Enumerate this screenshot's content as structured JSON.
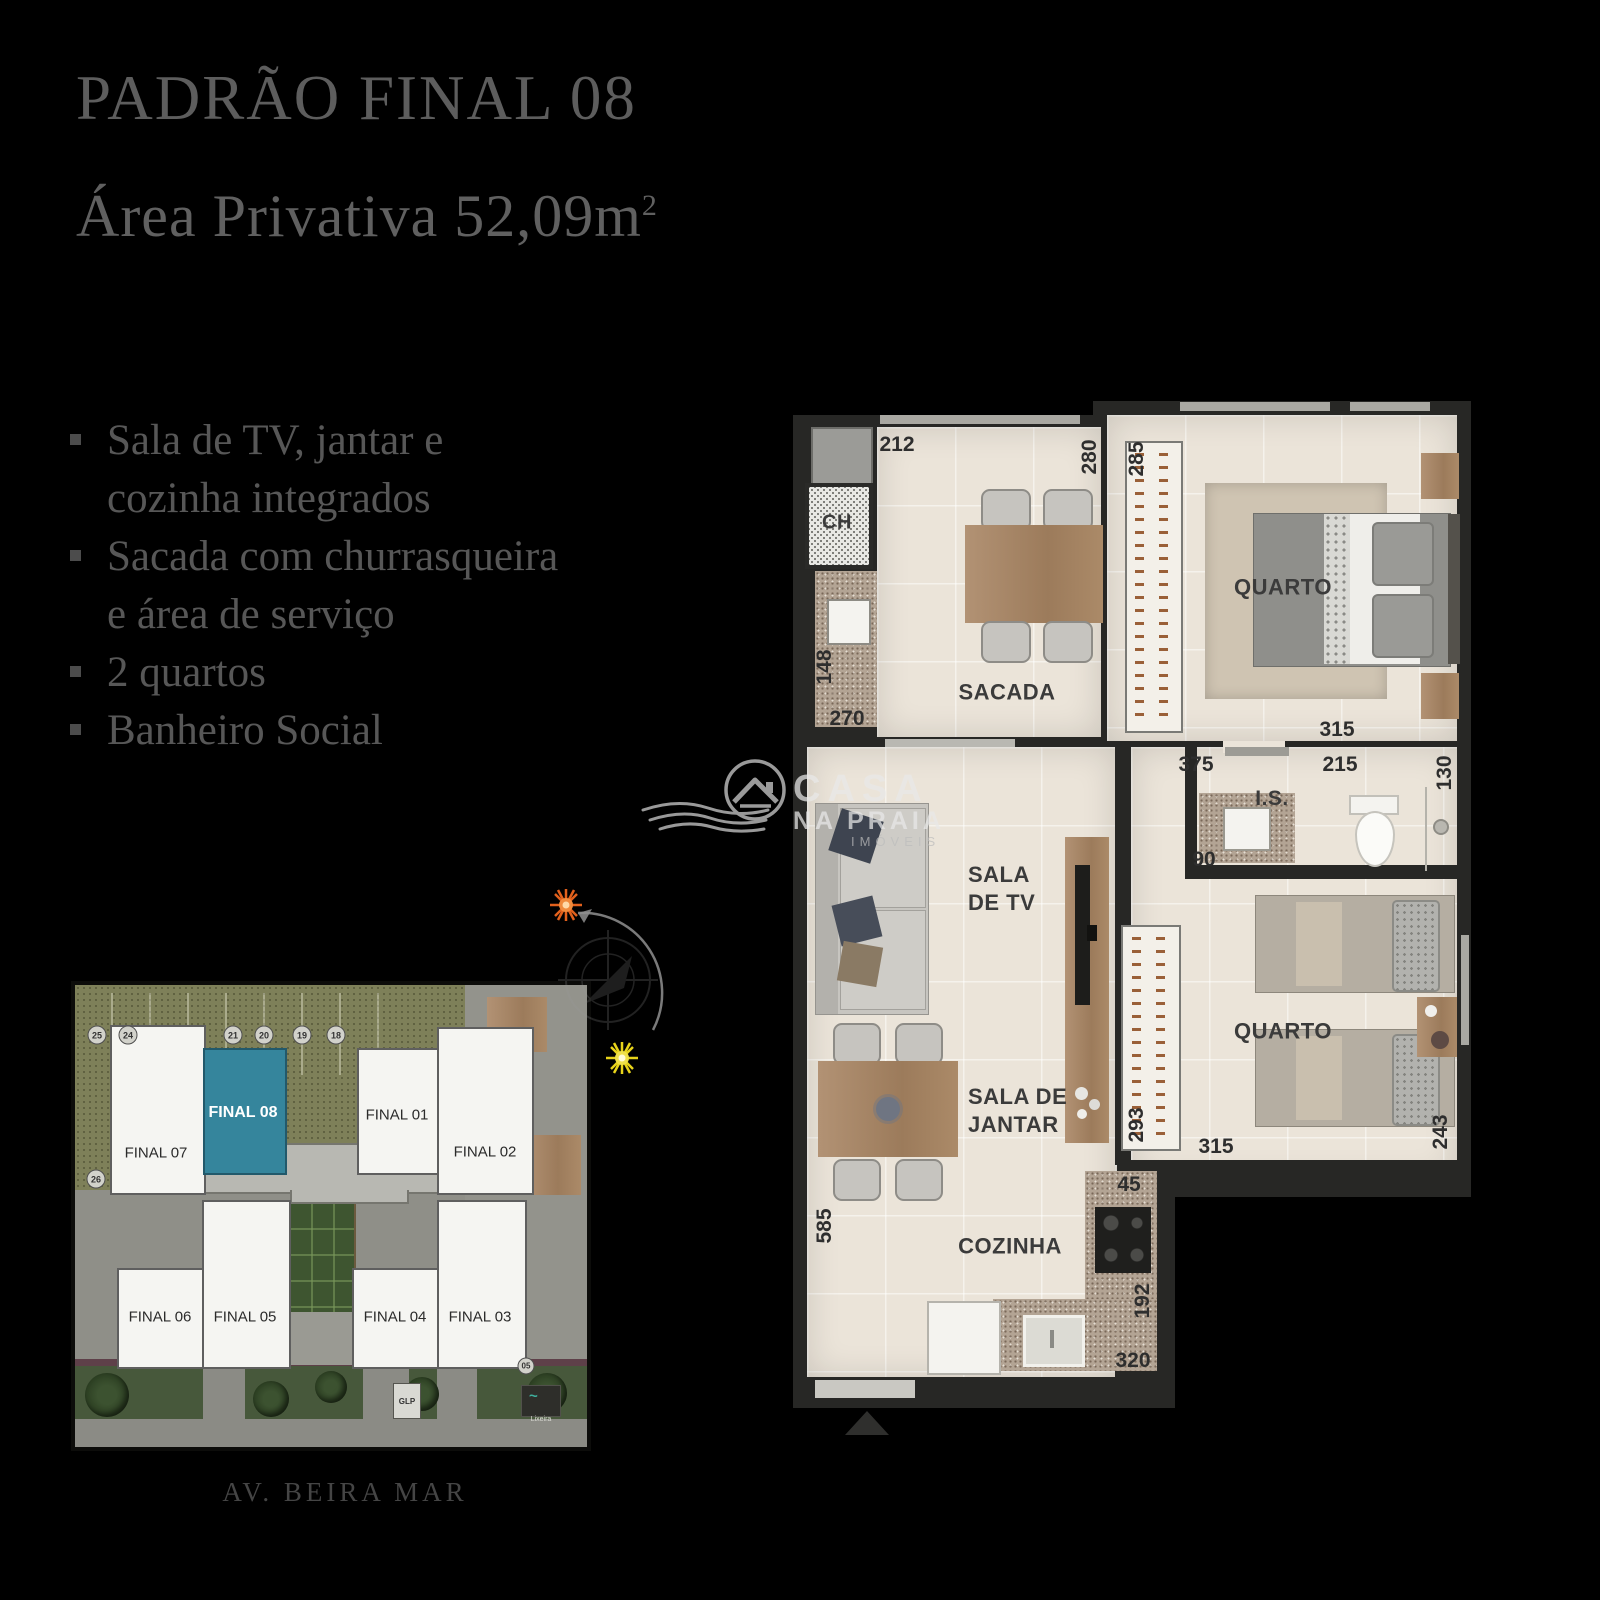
{
  "slide": {
    "title": "PADRÃO FINAL 08",
    "subtitle": "Área Privativa 52,09m",
    "subtitle_sup": "2",
    "features": [
      "Sala de TV, jantar e\ncozinha integrados",
      "Sacada com churrasqueira\ne área de serviço",
      "2 quartos",
      "Banheiro Social"
    ]
  },
  "logo": {
    "name": "CASA",
    "name2": "NA PRAIA",
    "tagline": "IMÓVEIS"
  },
  "plan": {
    "labels": {
      "ch": "CH",
      "sacada": "SACADA",
      "quarto1": "QUARTO",
      "is": "I.S.",
      "sala_tv": "SALA\nDE TV",
      "sala_jantar": "SALA DE\nJANTAR",
      "quarto2": "QUARTO",
      "cozinha": "COZINHA"
    },
    "dims": [
      {
        "t": "212"
      },
      {
        "t": "280"
      },
      {
        "t": "285"
      },
      {
        "t": "148"
      },
      {
        "t": "270"
      },
      {
        "t": "315"
      },
      {
        "t": "375"
      },
      {
        "t": "215"
      },
      {
        "t": "130"
      },
      {
        "t": "90"
      },
      {
        "t": "293"
      },
      {
        "t": "315"
      },
      {
        "t": "243"
      },
      {
        "t": "45"
      },
      {
        "t": "585"
      },
      {
        "t": "192"
      },
      {
        "t": "320"
      }
    ]
  },
  "site": {
    "units": [
      {
        "label": "FINAL 08",
        "highlight": true
      },
      {
        "label": "FINAL 07",
        "highlight": false
      },
      {
        "label": "FINAL 01",
        "highlight": false
      },
      {
        "label": "FINAL 02",
        "highlight": false
      },
      {
        "label": "FINAL 06",
        "highlight": false
      },
      {
        "label": "FINAL 05",
        "highlight": false
      },
      {
        "label": "FINAL 04",
        "highlight": false
      },
      {
        "label": "FINAL 03",
        "highlight": false
      }
    ],
    "parking": [
      "25",
      "24",
      "21",
      "20",
      "19",
      "18",
      "26"
    ],
    "spot": "05",
    "glp": "GLP",
    "lixeira": "Lixeira",
    "street": "AV. BEIRA MAR"
  },
  "colors": {
    "background": "#000000",
    "accent_teal": "#35859c",
    "sun_orange": "#e2601c",
    "sun_yellow": "#e8d41a"
  }
}
